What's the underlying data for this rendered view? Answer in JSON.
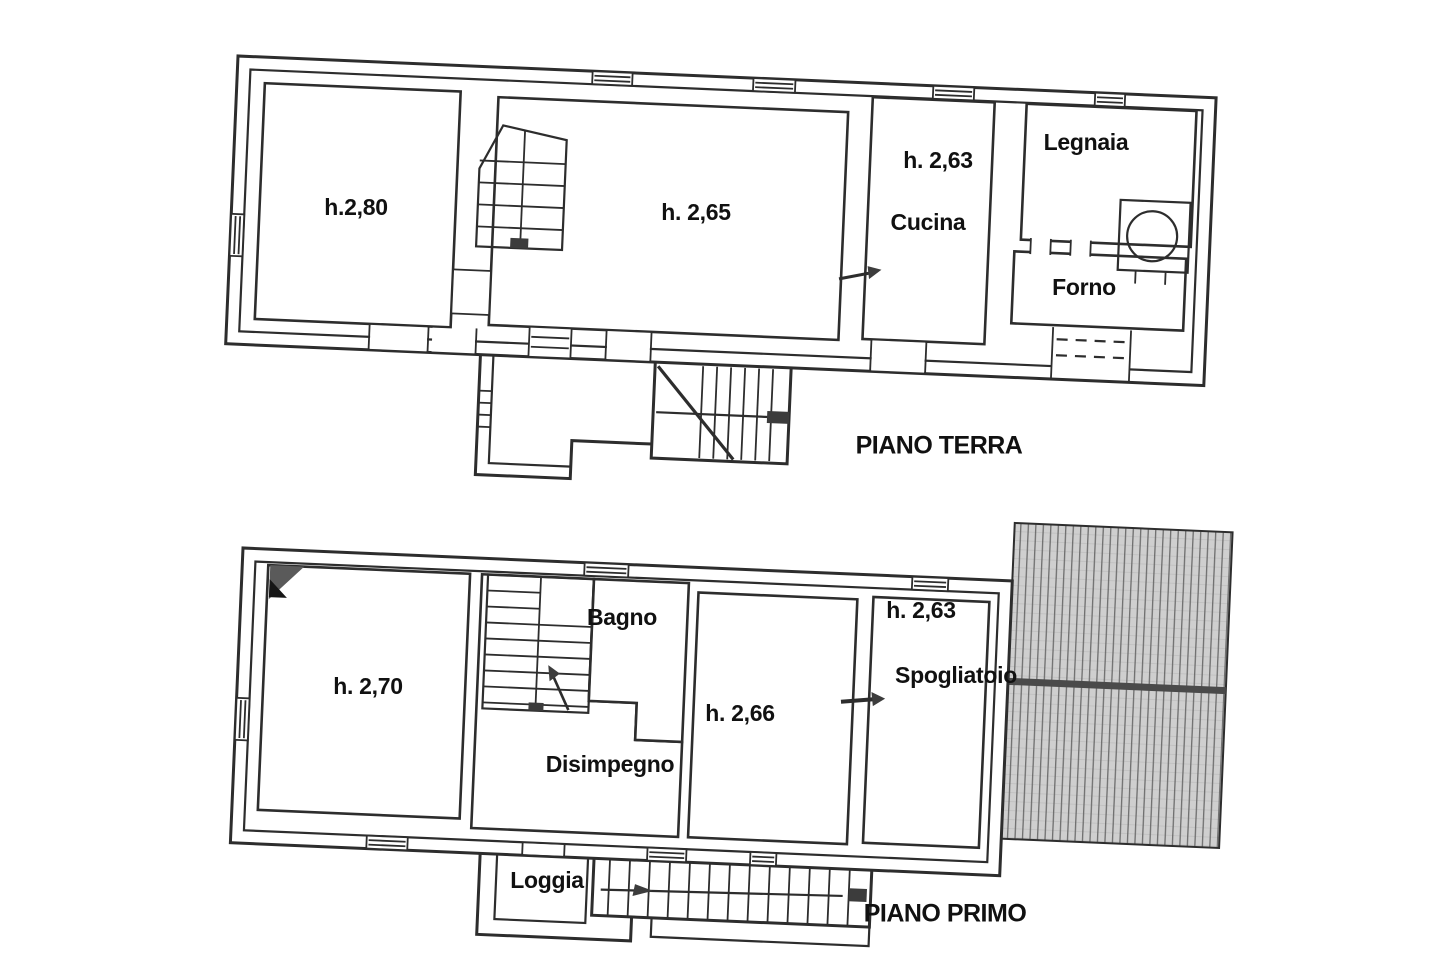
{
  "ground_floor": {
    "label": "PIANO TERRA",
    "rooms": {
      "room_left_height": "h.2,80",
      "room_main_height": "h. 2,65",
      "kitchen_height": "h. 2,63",
      "kitchen": "Cucina",
      "woodshed": "Legnaia",
      "oven_room": "Forno"
    }
  },
  "first_floor": {
    "label": "PIANO PRIMO",
    "rooms": {
      "room_left_height": "h. 2,70",
      "bathroom": "Bagno",
      "hallway": "Disimpegno",
      "room_main_height": "h. 2,66",
      "changing_room_height": "h. 2,63",
      "changing_room": "Spogliatoio",
      "loggia": "Loggia"
    }
  },
  "colors": {
    "line": "#2d2d2d",
    "text": "#111111",
    "roof_fill": "#cfcfcf",
    "roof_line": "#666666",
    "roof_ridge": "#4a4a4a",
    "marker": "#3c3c3c"
  }
}
